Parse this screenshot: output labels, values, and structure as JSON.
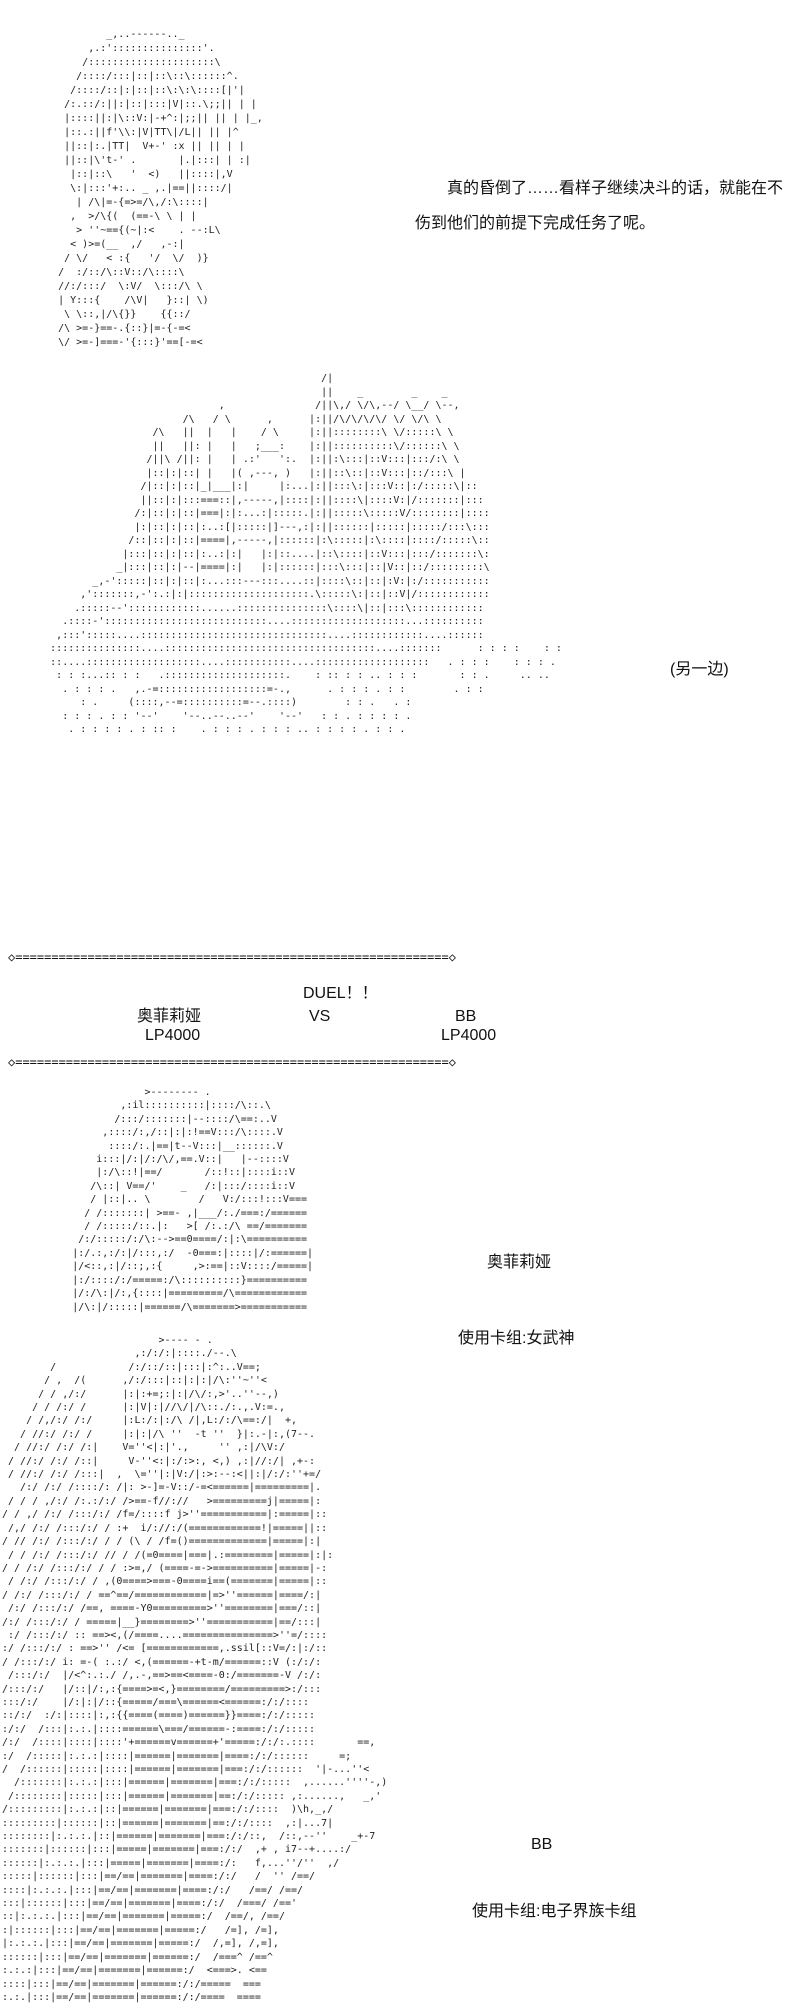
{
  "page": {
    "background": "#ffffff",
    "text_color": "#111111"
  },
  "dialogue": {
    "line1": "真的昏倒了……看样子继续决斗的话，就能在不",
    "line2": "伤到他们的前提下完成任务了呢。"
  },
  "captions": {
    "aside": "(另一边)",
    "left_duelist_name": "奥菲莉娅",
    "left_duelist_deck": "使用卡组:女武神",
    "right_duelist_name": "BB",
    "right_duelist_deck": "使用卡组:电子界族卡组"
  },
  "duel_banner": {
    "divider_top": "◇============================================================◇",
    "divider_bottom": "◇============================================================◇",
    "duel_label": "DUEL！！",
    "vs_label": "VS",
    "left": {
      "name": "奥菲莉娅",
      "lp": "LP4000"
    },
    "right": {
      "name": "BB",
      "lp": "LP4000"
    }
  },
  "ascii_art": {
    "fainted_girl": [
      "             _,..------.._",
      "          ,.:':::::::::::::::'.",
      "         /:::::::::::::::::::::\\",
      "        /::::/:::|::|::\\::\\::::::^.",
      "       /::::/::|:|::|::\\:\\:\\::::[|'|",
      "      /:.::/:||:|::|:::|V|::.\\;;|| | |",
      "      |::::||:|\\::V:|-+^:|;;|| || | |_,",
      "      |::.:||f'\\\\:|V|TT\\|/L|| || |^",
      "      ||::|:.|TT|  V+-' :x || || | |",
      "      ||::|\\'t-' .       |.|:::| | :|",
      "       |::|::\\   '  <)   ||::::|,V",
      "       \\:|:::'+:.. _ ,.|==||::::/|",
      "        | /\\|=-{=>=/\\,/:\\::::|",
      "       ,  >/\\{(  (==-\\ \\ | |",
      "        > ''~=={(~|:<    . --:L\\",
      "       < )>=(__  ,/   ,-:|",
      "      / \\/   < :{   '/  \\/  )}",
      "     /  :/::/\\::V::/\\::::\\",
      "     //:/:::/  \\:V/  \\:::/\\ \\",
      "     | Y:::{    /\\V|   }::| \\)",
      "      \\ \\::,|/\\{}}    {{::/",
      "     /\\ >=-}==-.{::}|=-{-=<",
      "     \\/ >=-]===-'{:::}'==[-=<"
    ],
    "castle_scene": [
      "                                                     /|",
      "                                                     ||    _        _    _",
      "                                    ,               /||\\,/ \\/\\,--/ \\__/ \\--,",
      "                              /\\   / \\      ,      |:||/\\/\\/\\/\\/ \\/ \\/\\ \\",
      "                         /\\   ||  |   |    / \\     |:||::::::::\\ \\/:::::\\ \\",
      "                         ||   ||: |   |   ;___:    |:||::::::::::\\/::::::\\ \\",
      "                        /||\\ /||: |   | .:'   ':.  |:||:\\:::|::V:::|:::/:\\ \\",
      "                        |::|:|::| |   |( ,---, )   |:||::\\::|::V:::|::/:::\\ |",
      "                       /|::|:|::|_|___|:|     |:...|:||:::\\:|:::V::|:/:::::\\|::",
      "                       ||::|:|:::===::|,-----,|::::|:||::::\\|::::V:|/:::::::|:::",
      "                      /:|::|:|::|===|:|:...:|:::::.|:||:::::\\:::::V/::::::::|::::",
      "                      |:|::|:|::|:..:[|:::::|]---,:|:||::::::|:::::|:::::/:::\\:::",
      "                     /::|::|:|::|====|,-----,|::::::|:\\:::::|:\\::::|::::/:::::\\::",
      "                    |:::|::|:|::|:..:|:|   |:|::....|::\\::::|::V:::|:::/:::::::\\:",
      "                   _|:::|::|:|--|====|:|   |:|::::::|:::\\:::|::|V::|::/:::::::::\\",
      "               _,-':::::|::|:|::|:...:::---:::....::|::::\\::|::|:V:|:/:::::::::::",
      "             ,':::::::,-':.:|:|::::::::::::::::::::.\\:::::\\:|::|::V|/::::::::::::",
      "            .:::::--'::::::::::::......:::::::::::::::\\::::\\|::|:::\\::::::::::::",
      "          .::::-':::::::::::::::::::::::::::....:::::::::::::::::::...::::::::::",
      "         ,:::':::::....:::::::::::::::::::::::::::::::....::::::::::::....::::::",
      "        :::::::::::::::....:::::::::::::::::::::::::::::::::::....:::::::      : : : :    : :",
      "        ::....:::::::::::::::::::....:::::::::::....:::::::::::::::::::   . : : :    : : : .",
      "         : : :...:: : :   .::::::::::::::::::::.    : :: : : .. : : :       : : .     .. ..",
      "          . : : : .   ,.-=::::::::::::::::::=-.,      . : : : . : :        . : :",
      "             : .     (::::,--=::::::::::=--.::::)        : : .   . :",
      "          : : : . : : '--'    '--..--..--'    '--'   : : . : : : : .",
      "           . : : : : . : :: :    . : : : . : : : .. : : : : . : : ."
    ],
    "ophelia_portrait": [
      "                      >-------- .",
      "                  ,:il::::::::::|::::/\\::.\\",
      "                 /:::/:::::::|--::::/\\==:..V",
      "               ,::::/:,/::|:|:!==V:::/\\::::.V",
      "                ::::/:.|==|t--V:::|__::::::.V",
      "              i:::|/:|/:/\\/,==.V::|   |--::::V",
      "              |:/\\::!|==/       /::!::|::::i::V",
      "             /\\::| V==/'    _   /:|:::/::::i::V",
      "             / |::|.. \\        /   V:/:::!:::V===",
      "            / /:::::::| >==- ,|___/:./===:/======",
      "            / /:::::/::.|:   >[ /:.:/\\ ==/=======",
      "           /:/:::::/:/\\:-->==0====/:|:\\==========",
      "          |:/.:,:/:|/:::,:/  -0===:|::::|/:======|",
      "          |/<::,:|/::;,:{     ,>:==|::V::::/=====|",
      "          |:/::::/:/=====:/\\::::::::::}==========",
      "          |/:/\\:|/:,{::::|=========/\\============",
      "          |/\\:|/:::::|======/\\=======>==========="
    ],
    "bb_portrait": [
      "                          >---- - .",
      "                      ,:/:/:|::::./--.\\",
      "        /            /:/::/::|:::|:^:..V==;",
      "       / ,  /(      ,/:/:::|::|:|:|/\\:''~''<",
      "      / / ,/:/      |:|:+=;:|:|/\\/:,>'..''--,)",
      "     / / /:/ /      |:|V|:|//\\/|/\\::./:.,.V:=.,",
      "    / /,/:/ /:/     |:L:/:|:/\\ /|,L:/:/\\==:/|  +,",
      "   / //:/ /:/ /     |:|:|/\\ ''  -t ''  }|:.-|:,(7--.",
      "  / //:/ /:/ /:|    V=''<|:|'.,     '' ,:|/\\V:/",
      " / //:/ /:/ /::|     V-''<:|:/:>:, <,) ,:|//:/| ,+-:",
      " / //:/ /:/ /:::|  ,  \\=''|:|V:/|:>:--:<||:|/:/:''+=/",
      "   /:/ /:/ /::::/: /|: >-]=-V::/-=<======|=========|.",
      " / / / ,/:/ /:.:/:/ />==-f//://   >=========j|=====|:",
      "/ / ,/ /:/ /:::/:/ /f=/::::f j>''===========|:=====|::",
      " /,/ /:/ /:::/:/ / :+  i/://:/(============!|=====||::",
      "/ // /:/ /:::/:/ / / (\\ / /f=()=============|=====|:|",
      " / / /:/ /:::/:/ // / /(=0====|===|.:========|=====|:|:",
      "/ / /:/ /:::/:/ / / :>=,/ (====-=->==========|=====|-:",
      " / /:/ /:::/:/ / ,(0====>===-0====i==(=======|=====|::",
      "/ /:/ /:::/:/ / ==^==/============|=>''======|====/:|",
      " /:/ /:::/:/ /==, ====-Y0=========>''========|===/::|",
      "/:/ /:::/:/ / =====|__}========>''===========|==/:::|",
      " :/ /:::/:/ :: ==><,(/====....===============>''=/::::",
      ":/ /:::/:/ : ==>'' /<= [============,.ssil[::V=/:|:/::",
      "/ /:::/:/ i: =-( :.:/ <,(======-+t-m/======::V (:/:/:",
      " /:::/:/  |/<^:.:./ /,.-,==>==<====-0:/=======-V /:/:",
      "/:::/:/   |/::|/:,:{====>=<,}========/=========>:/:::",
      ":::/:/    |/:|:|/::{=====/===\\======<======:/:/::::",
      "::/:/  :/:|::::|:,:{{====(====)======}}====:/:/:::::",
      ":/:/  /:::|:.:.|::::======\\===/======-:====:/:/:::::",
      "/:/  /::::|::::|::::'+======v======+'=====:/:/:.::::       ==,",
      ":/  /:::::|:.:.:|::::|======|=======|====:/:/::::::     =;",
      "/  /::::::|:::::|::::|======|=======|===:/:/::::::  '|-...''<",
      "  /:::::::|:.:.:|:::|======|=======|===:/:/:::::  ,......''''-,)",
      " /::::::::|:::::|:::|======|=======|==:/:/::::: ,:......,   _,'",
      "/:::::::::|:.:.:|::|======|=======|===:/:/::::  )\\h,_,/",
      ":::::::::|::::::|::|======|=======|==:/:/::::  ,:|...7|",
      "::::::::|:.:.:.|::|======|=======|===:/:/::,  /::,--''    _+-7",
      ":::::::|::::::|:::|=====|=======|===:/:/  ,+ , i7--+....:/",
      "::::::|:.:.:.|:::|=====|=======|====:/:   f,...''/''  ,/",
      ":::::|::::::|:::|==/==|=======|====:/:/   /  '' /==/",
      "::::|:.:.:.|:::|==/==|=======|====:/:/   /==/ /==/",
      ":::|::::::|:::|==/==|=======|====:/:/  /===/ /=='",
      "::|:.:.:.|:::|==/==|=======|=====:/  /==/, /==/",
      ":|::::::|:::|==/==|=======|=====:/   /=], /=],",
      "|:.:.:.|:::|==/==|=======|=====:/  /,=], /,=],",
      "::::::|:::|==/==|=======|======:/  /===^ /==^",
      ":.:.:|:::|==/==|=======|======:/  <===>. <==",
      "::::|:::|==/==|=======|======:/:/=====  ===",
      ":.:.|:::|==/==|=======|======:/:/====  ===="
    ]
  }
}
